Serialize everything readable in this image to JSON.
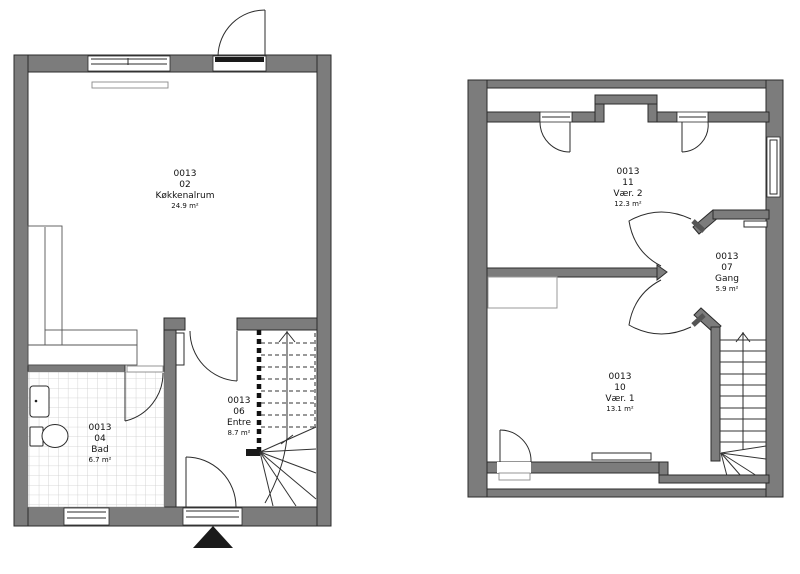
{
  "plans": [
    {
      "id": "ground-floor",
      "rooms": [
        {
          "code": "0013",
          "number": "02",
          "name": "Køkkenalrum",
          "area": "24.9 m²"
        },
        {
          "code": "0013",
          "number": "04",
          "name": "Bad",
          "area": "6.7 m²"
        },
        {
          "code": "0013",
          "number": "06",
          "name": "Entre",
          "area": "8.7 m²"
        }
      ]
    },
    {
      "id": "upper-floor",
      "rooms": [
        {
          "code": "0013",
          "number": "11",
          "name": "Vær. 2",
          "area": "12.3 m²"
        },
        {
          "code": "0013",
          "number": "07",
          "name": "Gang",
          "area": "5.9 m²"
        },
        {
          "code": "0013",
          "number": "10",
          "name": "Vær. 1",
          "area": "13.1 m²"
        }
      ]
    }
  ],
  "colors": {
    "wall": "#7c7c7c",
    "line": "#2b2b2b",
    "tile": "#cccccc"
  }
}
